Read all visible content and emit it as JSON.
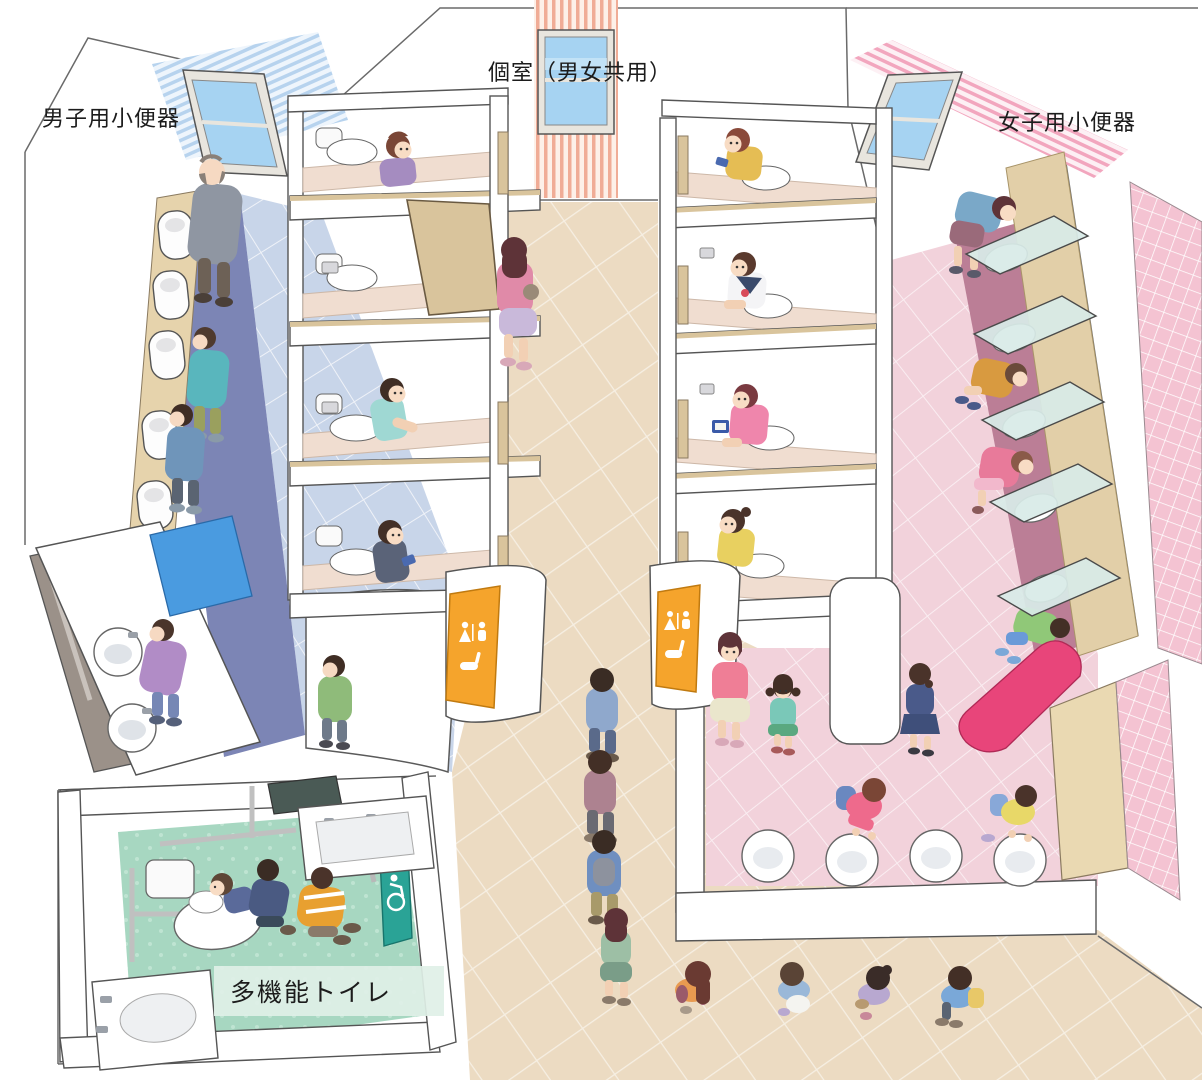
{
  "labels": {
    "boys_urinals": "男子用小便器",
    "shared_stalls": "個室（男女共用）",
    "girls_urinals": "女子用小便器",
    "multifunction_toilet": "多機能トイレ"
  },
  "signs": {
    "unisex_stall_sign": {
      "pictogram": "female-and-male-figures-with-toilet",
      "color": "#f5a42c",
      "instances": 2
    },
    "accessible_sign": {
      "pictogram": "wheelchair-symbol",
      "color": "#2aa396",
      "instances": 1
    }
  },
  "palette": {
    "outline": "#4d4d4d",
    "floor_corridor": "#ecdbc2",
    "floor_boys": "#c8d5e9",
    "floor_girls": "#f2d2db",
    "floor_multifunction": "#a7d7c1",
    "mat_boys": "#7c85b5",
    "mat_girls": "#bb7e96",
    "stripe_blue": "#b7d3ee",
    "stripe_salmon": "#f0ac96",
    "stripe_pink": "#f2a6be",
    "accent_blue_panel": "#4a9be0",
    "accent_magenta_panel": "#e8457a",
    "window_glass": "#a6d3f2",
    "door_wood": "#d9c49c",
    "glass_screen": "#d8ebe7"
  }
}
